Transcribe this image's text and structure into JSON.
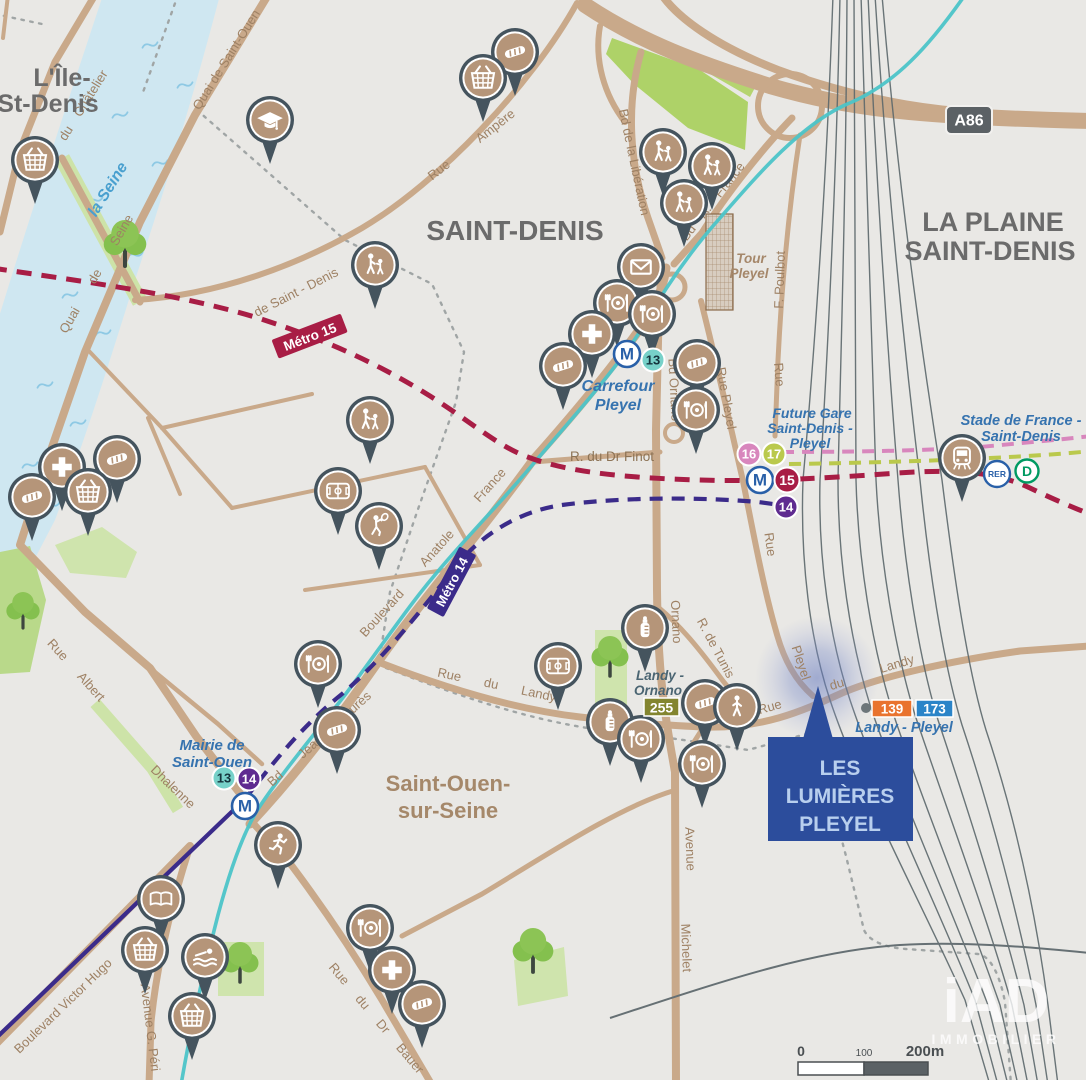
{
  "title_labels": {
    "ile_line1": "L'Île-",
    "ile_line2": "St-Denis",
    "saint_denis": "SAINT-DENIS",
    "la_plaine_line1": "LA PLAINE",
    "la_plaine_line2": "SAINT-DENIS",
    "saint_ouen_line1": "Saint-Ouen-",
    "saint_ouen_line2": "sur-Seine"
  },
  "river": {
    "name": "la Seine"
  },
  "streets": {
    "quai_du_chatelier": "Quai du Châtelier",
    "quai_de_saint_ouen": "Quai de Saint-Ouen",
    "quai_de_seine": "Quai  de  Seine",
    "rue_de_saint_denis": "de Saint - Denis",
    "rue_ampere": "Rue  Ampère",
    "bd_liberation": "Bd de la Libération",
    "bd_a_france": "Bd  A. France",
    "f_poulbot": "F.  Poulbot",
    "rue_poulbot": "Rue",
    "bd_ornano": "Bd Ornano",
    "ornano": "Ornano",
    "anatole_1": "Boulevard",
    "anatole_2": "Anatole",
    "anatole_3": "France",
    "bd_jean_jaures": "Bd  Jean  Jaurès",
    "dhalenne": "Dhalenne",
    "bd_victor_hugo": "Boulevard Victor Hugo",
    "avenue_g_peri": "Avenue G. Péri",
    "rue_du_dr_bauer": "Rue  du  Dr  Bauer",
    "avenue": "Avenue",
    "michelet": "Michelet",
    "rue_du_landy_w": "Rue  du  Landy",
    "rue_e": "Rue",
    "du_e": "du",
    "landy_e": "Landy",
    "rue_albert": "Rue  Albert",
    "r_du_dr_finot": "R. du Dr Finot",
    "r_de_tunis": "R. de Tunis",
    "rue_pleyel": "Rue Pleyel",
    "rue_pleyel_s_rue": "Rue",
    "rue_pleyel_s_pleyel": "Pleyel"
  },
  "transit": {
    "metro15_label": "Métro 15",
    "metro14_label": "Métro 14",
    "carrefour_line1": "Carrefour",
    "carrefour_line2": "Pleyel",
    "mairie_line1": "Mairie de",
    "mairie_line2": "Saint-Ouen",
    "future_line1": "Future Gare",
    "future_line2": "Saint-Denis -",
    "future_line3": "Pleyel",
    "stade_line1": "Stade de France -",
    "stade_line2": "Saint-Denis",
    "landy_pleyel": "Landy - Pleyel",
    "landy_ornano_line1": "Landy -",
    "landy_ornano_line2": "Ornano",
    "m": "M",
    "line13": "13",
    "line14": "14",
    "line15": "15",
    "line16": "16",
    "line17": "17",
    "rer": "RER",
    "rer_d": "D",
    "bus139": "139",
    "bus173": "173",
    "bus255": "255"
  },
  "landmarks": {
    "tour_line1": "Tour",
    "tour_line2": "Pleyel",
    "a86": "A86"
  },
  "project": {
    "line1": "LES",
    "line2": "LUMIÈRES",
    "line3": "PLEYEL"
  },
  "scale_bar": {
    "zero": "0",
    "mid": "100",
    "end": "200m"
  },
  "logo": {
    "brand": "iAD",
    "sub": "IMMOBILIER"
  },
  "colors": {
    "background": "#e9e8e5",
    "road": "#c9a98a",
    "river": "#cfe7f1",
    "metro15": "#a81d45",
    "metro14": "#3b2b8a",
    "tram": "#4cc4c8",
    "line13": "#77d1c9",
    "line14_badge": "#5f2b90",
    "line16": "#d886bd",
    "line17": "#bac94c",
    "rer_blue": "#2960a8",
    "rer_d_green": "#009a62",
    "bus139": "#e9732e",
    "bus173": "#2a84c8",
    "bus255": "#83852f",
    "pin_ring": "#45545e",
    "pin_fill": "#b59579",
    "project_bg": "#2c4d9c"
  },
  "pois": [
    {
      "icon": "shopping-basket",
      "x": 35,
      "y": 160
    },
    {
      "icon": "graduation-cap",
      "x": 270,
      "y": 120
    },
    {
      "icon": "bread",
      "x": 515,
      "y": 52
    },
    {
      "icon": "shopping-basket",
      "x": 483,
      "y": 78
    },
    {
      "icon": "school-children",
      "x": 663,
      "y": 152
    },
    {
      "icon": "school-children",
      "x": 712,
      "y": 166
    },
    {
      "icon": "school-children",
      "x": 684,
      "y": 203
    },
    {
      "icon": "post-envelope",
      "x": 641,
      "y": 267
    },
    {
      "icon": "restaurant",
      "x": 617,
      "y": 303
    },
    {
      "icon": "restaurant",
      "x": 652,
      "y": 314
    },
    {
      "icon": "pharmacy-cross",
      "x": 592,
      "y": 334
    },
    {
      "icon": "bread",
      "x": 563,
      "y": 366
    },
    {
      "icon": "bread",
      "x": 697,
      "y": 363
    },
    {
      "icon": "restaurant",
      "x": 696,
      "y": 410
    },
    {
      "icon": "school-children",
      "x": 375,
      "y": 265
    },
    {
      "icon": "school-children",
      "x": 370,
      "y": 420
    },
    {
      "icon": "stadium",
      "x": 338,
      "y": 491
    },
    {
      "icon": "tennis",
      "x": 379,
      "y": 526
    },
    {
      "icon": "bread",
      "x": 117,
      "y": 459
    },
    {
      "icon": "pharmacy-cross",
      "x": 62,
      "y": 467
    },
    {
      "icon": "shopping-basket",
      "x": 88,
      "y": 492
    },
    {
      "icon": "bread",
      "x": 32,
      "y": 497
    },
    {
      "icon": "restaurant",
      "x": 318,
      "y": 664
    },
    {
      "icon": "baby-bottle",
      "x": 645,
      "y": 628
    },
    {
      "icon": "stadium",
      "x": 558,
      "y": 666
    },
    {
      "icon": "baby-bottle",
      "x": 610,
      "y": 722
    },
    {
      "icon": "restaurant",
      "x": 641,
      "y": 739
    },
    {
      "icon": "bread",
      "x": 705,
      "y": 703
    },
    {
      "icon": "walker",
      "x": 737,
      "y": 707
    },
    {
      "icon": "restaurant",
      "x": 702,
      "y": 764
    },
    {
      "icon": "bread",
      "x": 337,
      "y": 730
    },
    {
      "icon": "runner",
      "x": 278,
      "y": 845
    },
    {
      "icon": "book",
      "x": 161,
      "y": 899
    },
    {
      "icon": "shopping-basket",
      "x": 145,
      "y": 950
    },
    {
      "icon": "swimmer",
      "x": 205,
      "y": 957
    },
    {
      "icon": "shopping-basket",
      "x": 192,
      "y": 1016
    },
    {
      "icon": "restaurant",
      "x": 370,
      "y": 928
    },
    {
      "icon": "pharmacy-cross",
      "x": 392,
      "y": 970
    },
    {
      "icon": "bread",
      "x": 422,
      "y": 1004
    },
    {
      "icon": "train-station",
      "x": 962,
      "y": 458
    }
  ]
}
